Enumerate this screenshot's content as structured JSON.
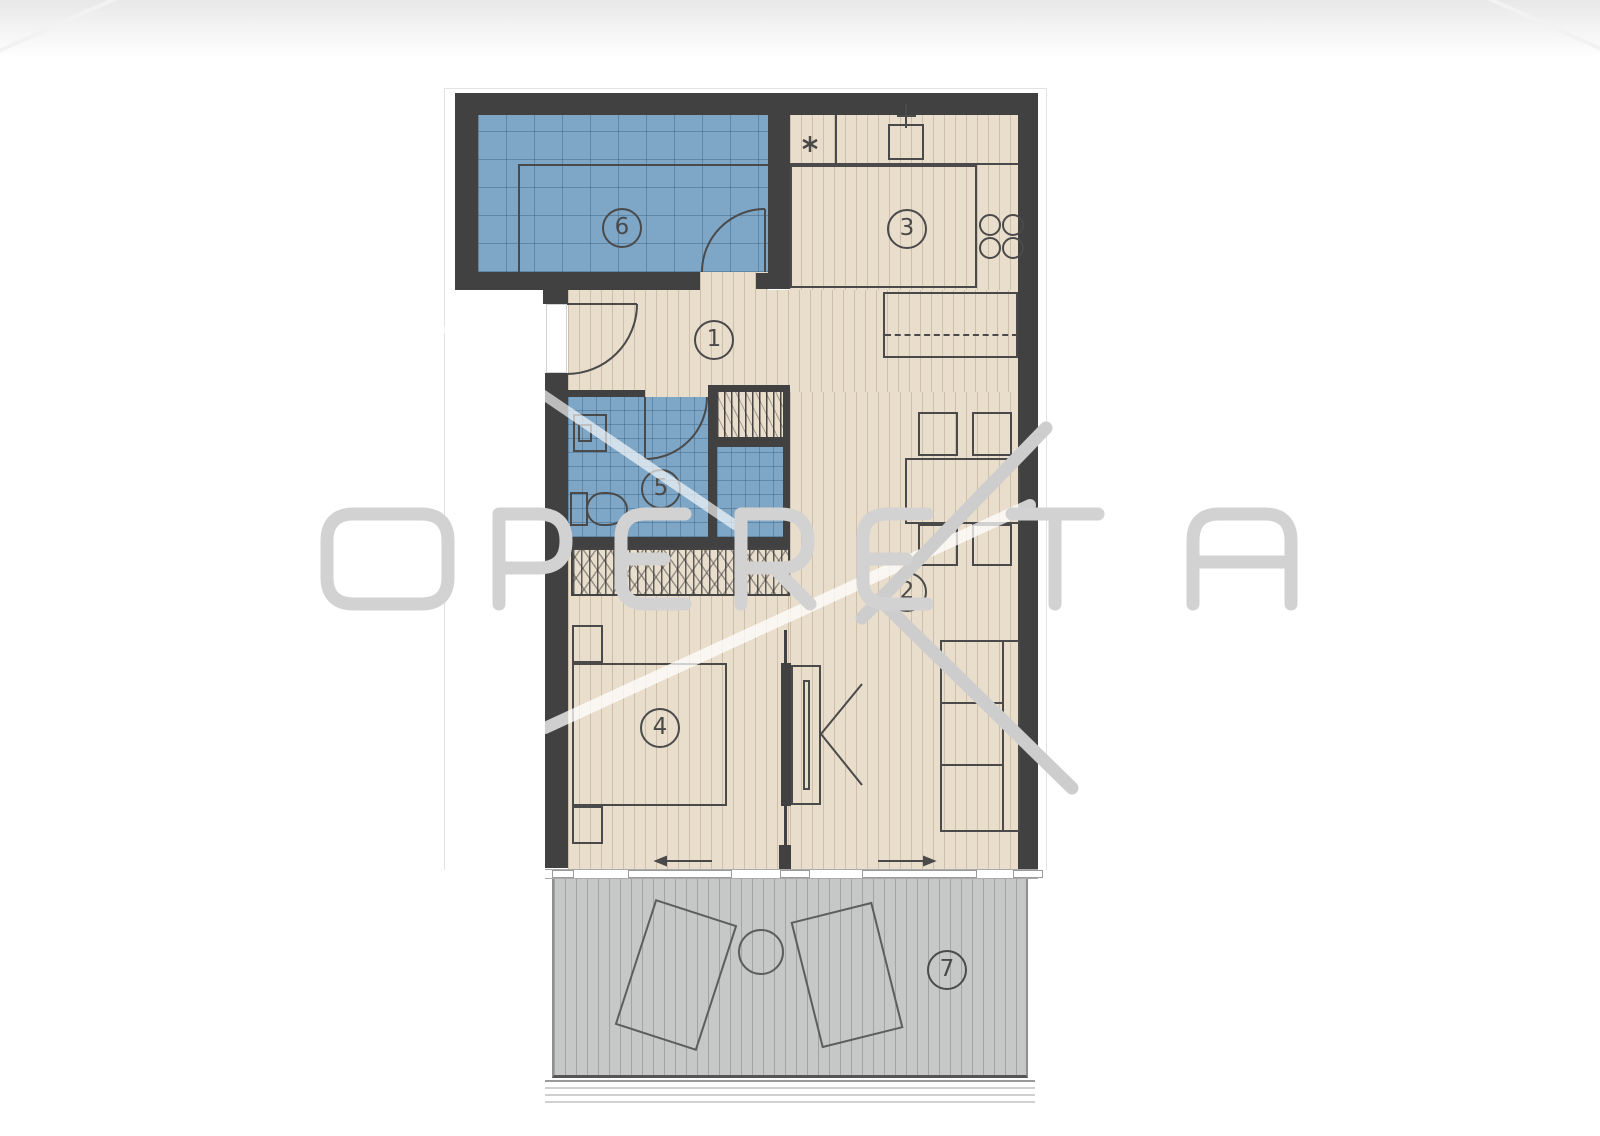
{
  "watermark": {
    "text": "OPERETA"
  },
  "plan": {
    "room_labels": [
      {
        "number": "1"
      },
      {
        "number": "2"
      },
      {
        "number": "3"
      },
      {
        "number": "4"
      },
      {
        "number": "5"
      },
      {
        "number": "6"
      },
      {
        "number": "7"
      }
    ]
  },
  "icons": {
    "sink": "sink-icon",
    "stove": "stove-burners-icon",
    "boiler": "asterisk-icon",
    "washing_machine": "washing-machine-icon",
    "toilet": "toilet-icon",
    "doors": "door-swing-arc-icon",
    "slide_left": "arrow-left-icon",
    "slide_right": "arrow-right-icon",
    "terrace_table": "round-table-icon",
    "loungers": "sun-lounger-icon"
  },
  "colors": {
    "wall": "#414141",
    "floor": "#e9ddcc",
    "tile_blue": "#7ea6c6",
    "terrace": "#c6c8c7",
    "linework": "#4a4a4a",
    "watermark": "#d2d2d2"
  }
}
